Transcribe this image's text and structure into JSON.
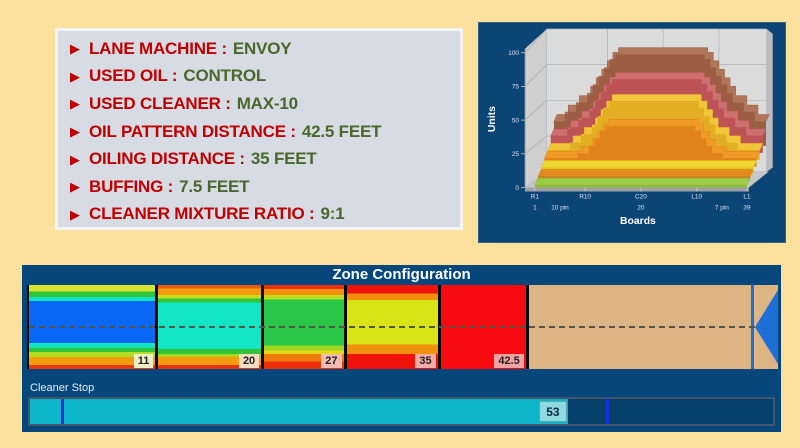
{
  "page": {
    "background": "#FBE09E"
  },
  "info_panel": {
    "bg": "#D7DBE3",
    "bullet_icon": "right-triangle",
    "bullet_glyph": "▶",
    "label_color": "#C00000",
    "value_color": "#49682B",
    "items": [
      {
        "label": "LANE MACHINE :",
        "value": "ENVOY"
      },
      {
        "label": "USED OIL :",
        "value": "CONTROL"
      },
      {
        "label": "USED CLEANER :",
        "value": "MAX-10"
      },
      {
        "label": "OIL PATTERN DISTANCE :",
        "value": "42.5 FEET"
      },
      {
        "label": "OILING DISTANCE :",
        "value": "35 FEET"
      },
      {
        "label": "BUFFING :",
        "value": "7.5 FEET"
      },
      {
        "label": "CLEANER MIXTURE RATIO :",
        "value": "9:1"
      }
    ]
  },
  "chart_data": {
    "type": "3d-stepped-area",
    "title": "",
    "xlabel": "Boards",
    "ylabel": "Units",
    "ylim": [
      0,
      100
    ],
    "xlim_boards": [
      1,
      39
    ],
    "y_ticks": [
      0,
      25,
      50,
      75,
      100
    ],
    "x_ticks_top": [
      {
        "b": 1,
        "label": "R1"
      },
      {
        "b": 10,
        "label": "R10"
      },
      {
        "b": 20,
        "label": "C20"
      },
      {
        "b": 30,
        "label": "L10"
      },
      {
        "b": 39,
        "label": "L1"
      }
    ],
    "x_ticks_bottom": [
      {
        "b": 1,
        "label": "1"
      },
      {
        "b": 5.5,
        "label": "10 pin"
      },
      {
        "b": 20,
        "label": "20"
      },
      {
        "b": 34.5,
        "label": "7 pin"
      },
      {
        "b": 39,
        "label": "39"
      }
    ],
    "grid": true,
    "panel_bg": "#0A4576",
    "wall_color": "#DBDBDB",
    "series": [
      {
        "name": "layer-brown",
        "color": "#B0765B",
        "face": "#9B5E42",
        "profile": [
          [
            1,
            26
          ],
          [
            3,
            26
          ],
          [
            3,
            36
          ],
          [
            5,
            36
          ],
          [
            5,
            46
          ],
          [
            7,
            46
          ],
          [
            7,
            56
          ],
          [
            8,
            56
          ],
          [
            8,
            65
          ],
          [
            9,
            65
          ],
          [
            9,
            74
          ],
          [
            10,
            74
          ],
          [
            10,
            83
          ],
          [
            11,
            83
          ],
          [
            11,
            92
          ],
          [
            12,
            92
          ],
          [
            12,
            97
          ],
          [
            28,
            97
          ],
          [
            28,
            92
          ],
          [
            29,
            92
          ],
          [
            29,
            83
          ],
          [
            30,
            83
          ],
          [
            30,
            74
          ],
          [
            31,
            74
          ],
          [
            31,
            65
          ],
          [
            32,
            65
          ],
          [
            32,
            56
          ],
          [
            33,
            56
          ],
          [
            33,
            46
          ],
          [
            35,
            46
          ],
          [
            35,
            36
          ],
          [
            37,
            36
          ],
          [
            37,
            26
          ],
          [
            39,
            26
          ]
        ]
      },
      {
        "name": "layer-red",
        "color": "#CF7070",
        "face": "#BE5357",
        "profile": [
          [
            1,
            18
          ],
          [
            4,
            18
          ],
          [
            4,
            27
          ],
          [
            6,
            27
          ],
          [
            6,
            37
          ],
          [
            8,
            37
          ],
          [
            8,
            47
          ],
          [
            9,
            47
          ],
          [
            9,
            56
          ],
          [
            10,
            56
          ],
          [
            10,
            65
          ],
          [
            11,
            65
          ],
          [
            11,
            73
          ],
          [
            12,
            73
          ],
          [
            12,
            78
          ],
          [
            28,
            78
          ],
          [
            28,
            73
          ],
          [
            29,
            73
          ],
          [
            29,
            65
          ],
          [
            30,
            65
          ],
          [
            30,
            56
          ],
          [
            31,
            56
          ],
          [
            31,
            47
          ],
          [
            32,
            47
          ],
          [
            32,
            37
          ],
          [
            34,
            37
          ],
          [
            34,
            27
          ],
          [
            36,
            27
          ],
          [
            36,
            18
          ],
          [
            39,
            18
          ]
        ]
      },
      {
        "name": "layer-yellow",
        "color": "#F0C63A",
        "face": "#E3AE24",
        "profile": [
          [
            1,
            10
          ],
          [
            5,
            10
          ],
          [
            5,
            18
          ],
          [
            7,
            18
          ],
          [
            7,
            27
          ],
          [
            9,
            27
          ],
          [
            9,
            37
          ],
          [
            10,
            37
          ],
          [
            10,
            46
          ],
          [
            11,
            46
          ],
          [
            11,
            55
          ],
          [
            12,
            55
          ],
          [
            12,
            62
          ],
          [
            28,
            62
          ],
          [
            28,
            55
          ],
          [
            29,
            55
          ],
          [
            29,
            46
          ],
          [
            30,
            46
          ],
          [
            30,
            37
          ],
          [
            31,
            37
          ],
          [
            31,
            27
          ],
          [
            33,
            27
          ],
          [
            33,
            18
          ],
          [
            35,
            18
          ],
          [
            35,
            10
          ],
          [
            39,
            10
          ]
        ]
      },
      {
        "name": "layer-orange",
        "color": "#F09B28",
        "face": "#E2821A",
        "profile": [
          [
            1,
            9
          ],
          [
            7,
            9
          ],
          [
            7,
            14
          ],
          [
            9,
            14
          ],
          [
            9,
            22
          ],
          [
            10,
            22
          ],
          [
            10,
            30
          ],
          [
            11,
            30
          ],
          [
            11,
            38
          ],
          [
            12,
            38
          ],
          [
            12,
            43
          ],
          [
            28,
            43
          ],
          [
            28,
            38
          ],
          [
            29,
            38
          ],
          [
            29,
            30
          ],
          [
            30,
            30
          ],
          [
            30,
            22
          ],
          [
            31,
            22
          ],
          [
            31,
            14
          ],
          [
            33,
            14
          ],
          [
            33,
            9
          ],
          [
            39,
            9
          ]
        ]
      },
      {
        "name": "strip-yellow",
        "color": "#EFD832",
        "face": "#E0C01E",
        "profile": [
          [
            1,
            6.5
          ],
          [
            39,
            6.5
          ]
        ]
      },
      {
        "name": "strip-orange",
        "color": "#E28A1E",
        "face": "#D0761A",
        "profile": [
          [
            1,
            4.2
          ],
          [
            39,
            4.2
          ]
        ]
      },
      {
        "name": "strip-green",
        "color": "#9CCB45",
        "face": "#8ABB36",
        "profile": [
          [
            1,
            2.6
          ],
          [
            39,
            2.6
          ]
        ]
      }
    ],
    "tick_color": "#DDE2EE",
    "axis_title_color": "#FFFFFF"
  },
  "zone_panel": {
    "title": "Zone Configuration",
    "bg": "#05477A",
    "px_per_foot": 11.76,
    "tan_color": "#DDB584",
    "marker_color": "#1E6FD6",
    "zones": [
      {
        "label": "11",
        "width_ft": 11,
        "tag_bg": "#EFEFC5",
        "bands": [
          [
            "#D9E430",
            8
          ],
          [
            "#2FC43A",
            6
          ],
          [
            "#10E2C2",
            5
          ],
          [
            "#0A68F6",
            50
          ],
          [
            "#10E2C2",
            6
          ],
          [
            "#2FC43A",
            5
          ],
          [
            "#B5DC20",
            6
          ],
          [
            "#F29D0E",
            9
          ],
          [
            "#E83A10",
            5
          ]
        ]
      },
      {
        "label": "20",
        "width_ft": 9,
        "tag_bg": "#F5DCC2",
        "bands": [
          [
            "#E85A10",
            4
          ],
          [
            "#F59C0E",
            8
          ],
          [
            "#C8DC20",
            4
          ],
          [
            "#2FC43A",
            5
          ],
          [
            "#12E6C4",
            55
          ],
          [
            "#2FC43A",
            6
          ],
          [
            "#A5D822",
            4
          ],
          [
            "#F59C0E",
            9
          ],
          [
            "#E8330E",
            5
          ]
        ]
      },
      {
        "label": "27",
        "width_ft": 7,
        "tag_bg": "#F2BCB4",
        "bands": [
          [
            "#EE300C",
            5
          ],
          [
            "#F5900E",
            7
          ],
          [
            "#BCDC20",
            5
          ],
          [
            "#29C648",
            55
          ],
          [
            "#9ED820",
            6
          ],
          [
            "#E6D818",
            4
          ],
          [
            "#F07E0E",
            9
          ],
          [
            "#EE300C",
            9
          ]
        ]
      },
      {
        "label": "35",
        "width_ft": 8,
        "tag_bg": "#F5ACA6",
        "bands": [
          [
            "#F2120C",
            10
          ],
          [
            "#F58C0E",
            8
          ],
          [
            "#D9E416",
            53
          ],
          [
            "#EF900E",
            11
          ],
          [
            "#F2120C",
            18
          ]
        ]
      },
      {
        "label": "42.5",
        "width_ft": 7.5,
        "tag_bg": "#F2A0A0",
        "bands": [
          [
            "#F70A10",
            100
          ]
        ]
      }
    ],
    "cleaner_stop": {
      "label": "Cleaner Stop",
      "value": "53",
      "fill_pct": 72.4,
      "marker1_pct": 4.2,
      "marker2_pct": 77.5,
      "fill_color": "#0CB5C9",
      "track_color": "#05406B",
      "value_bg": "#8EDAE0",
      "marker_color": "#1B2BE0"
    }
  }
}
